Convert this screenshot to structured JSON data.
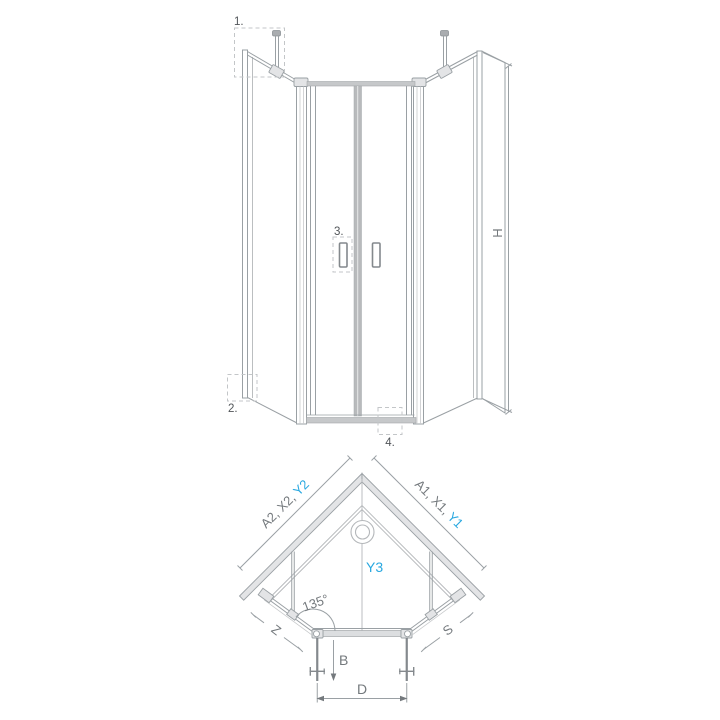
{
  "colors": {
    "line": "#9aa0a4",
    "line_light": "#b4b7ba",
    "fill_light": "#e3e4e6",
    "fill_bar": "#c6c8ca",
    "text_dim": "#74797d",
    "text_dark": "#515559",
    "accent_blue": "#29a8e0",
    "dash": "#c3c6c8",
    "background": "#ffffff"
  },
  "elevation": {
    "callout_1": "1.",
    "callout_2": "2.",
    "callout_3": "3.",
    "callout_4": "4.",
    "height_label": "H"
  },
  "plan": {
    "left_wall_dim_gray": "A2, X2, ",
    "left_wall_dim_blue": "Y2",
    "right_wall_dim_gray": "A1, X1, ",
    "right_wall_dim_blue": "Y1",
    "depth_label": "Y3",
    "angle_label": "135°",
    "left_side_label": "Z",
    "right_side_label": "S",
    "door_label": "B",
    "entry_label": "D"
  }
}
